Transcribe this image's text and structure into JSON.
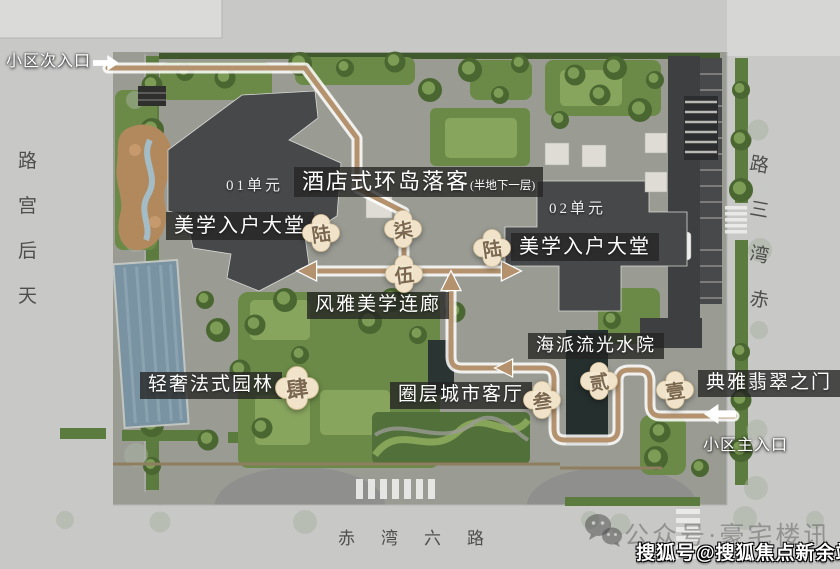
{
  "plan": {
    "roads": {
      "left_vertical": {
        "name": "天后宫路",
        "display_chars": [
          "路",
          "宫",
          "后",
          "天"
        ]
      },
      "right_vertical": {
        "name": "赤湾三路",
        "display_chars": [
          "路",
          "三",
          "湾",
          "赤"
        ]
      },
      "bottom_horizontal": {
        "name": "赤湾六路",
        "display_chars": [
          "赤",
          "湾",
          "六",
          "路"
        ]
      }
    },
    "entrances": {
      "secondary": {
        "label": "小区次入口",
        "arrow_direction": "right"
      },
      "main": {
        "label": "小区主入口",
        "arrow_direction": "left"
      }
    },
    "units": {
      "unit01": "01单元",
      "unit02": "02单元"
    },
    "features": {
      "hotel_dropoff": {
        "label": "酒店式环岛落客",
        "note": "(半地下一层)"
      },
      "lobby_left": {
        "label": "美学入户大堂"
      },
      "lobby_right": {
        "label": "美学入户大堂"
      },
      "corridor": {
        "label": "风雅美学连廊"
      },
      "french_garden": {
        "label": "轻奢法式园林"
      },
      "city_livingroom": {
        "label": "圈层城市客厅"
      },
      "water_court": {
        "label": "海派流光水院"
      },
      "jade_gate": {
        "label": "典雅翡翠之门"
      }
    },
    "route_badges": {
      "one": "壹",
      "two": "贰",
      "three": "叁",
      "four": "肆",
      "five": "伍",
      "six_left": "陆",
      "six_right": "陆",
      "seven": "柒"
    },
    "watermarks": {
      "wechat": {
        "label": "公众号·豪宅楼讯",
        "icon": "wechat-icon"
      },
      "sohu": {
        "label": "搜狐号@搜狐焦点新余站"
      }
    },
    "colors": {
      "road": "#c8c8c7",
      "site_paving": "#9a9c94",
      "building": "#46484a",
      "greenery": "#6b8a48",
      "pool": "#7a93a2",
      "route": "#b3926d",
      "badge_fill": "#f0e3c9",
      "badge_text": "#7c6850",
      "label_bg": "rgba(36,36,34,0.78)"
    }
  }
}
